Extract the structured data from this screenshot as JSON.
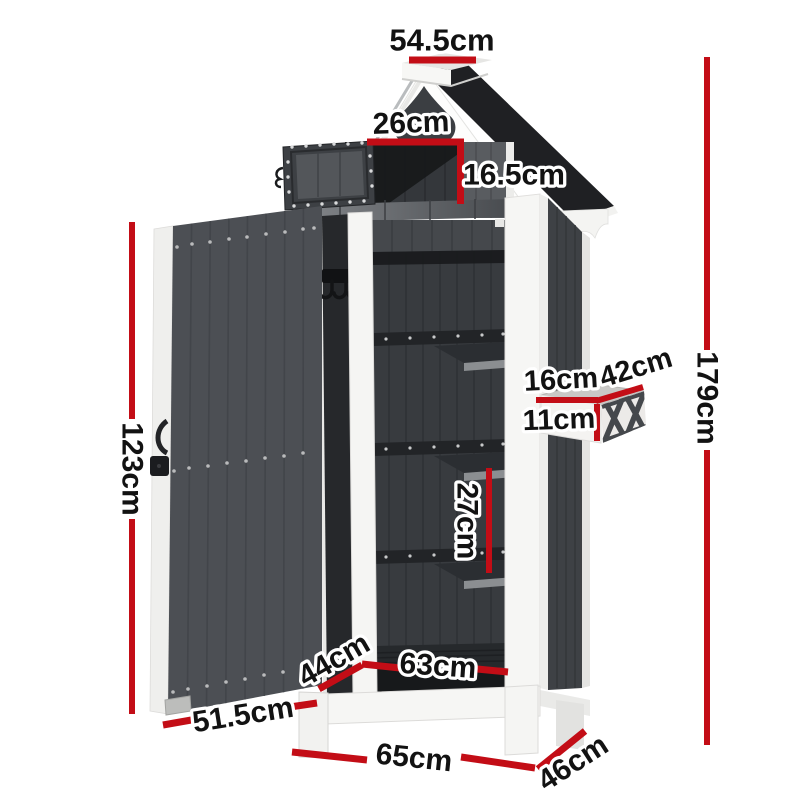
{
  "diagram": {
    "subject": "outdoor-storage-cabinet-dimension-diagram",
    "unit": "cm",
    "dimensions": {
      "roof_width": "54.5cm",
      "top_box_width": "26cm",
      "top_box_height": "16.5cm",
      "door_height": "123cm",
      "shelf_spacing": "27cm",
      "planter_depth": "16cm",
      "planter_top_width": "42cm",
      "planter_height": "11cm",
      "total_height": "179cm",
      "floor_depth": "44cm",
      "floor_width": "63cm",
      "door_width": "51.5cm",
      "base_width": "65cm",
      "base_depth": "46cm"
    },
    "colors": {
      "background": "#ffffff",
      "dimension_red": "#c30d16",
      "panel_dark": "#4c4f54",
      "interior_dark": "#383b3f",
      "roof_black": "#1f2023",
      "trim_white": "#f5f5f3"
    }
  }
}
